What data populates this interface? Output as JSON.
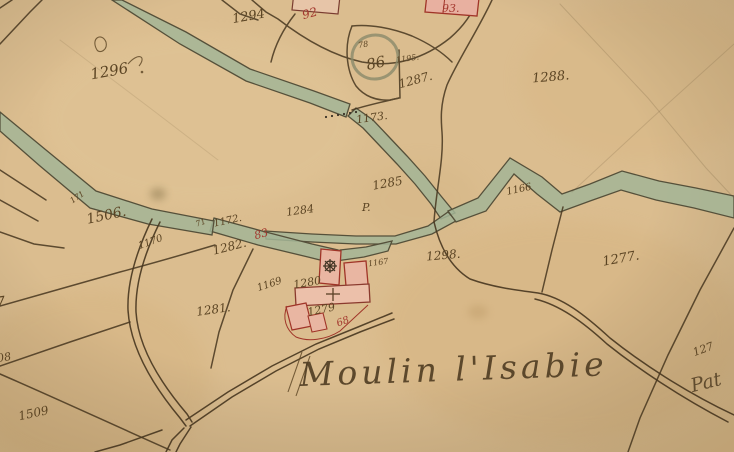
{
  "map": {
    "type": "historical-cadastral-map",
    "title": "Moulin l'Isabie",
    "colors": {
      "parchment": "#d8b88a",
      "water": "#a3b596",
      "ink": "#5b4423",
      "red_ink": "#a4392f",
      "building_fill": "#e9b6a2"
    }
  },
  "labels": {
    "n1294": "1294",
    "n92": "92",
    "n93": "93.",
    "n1296": "1296",
    "n1288": "1288.",
    "n78": "78",
    "n86": "86",
    "n1195": "1195.",
    "n1287": "1287.",
    "n1173": "1173.",
    "n1285": "1285",
    "nP": "P.",
    "n1166": "1166",
    "n1284": "1284",
    "n171": "171",
    "n1506": "1506.",
    "n1170": "1170",
    "n71": "71",
    "n1172": "1172.",
    "n83": "83",
    "n1282": "1282.",
    "n1298": "1298.",
    "n1277": "1277.",
    "n1169": "1169",
    "n1280": "1280",
    "n1167": "1167",
    "n1279": "1279",
    "n68": "68",
    "n1281": "1281.",
    "n1509": "1509",
    "n08": "08",
    "n7": "7",
    "n127": "127",
    "title": "Moulin l'Isabie",
    "pat": "Pat"
  }
}
